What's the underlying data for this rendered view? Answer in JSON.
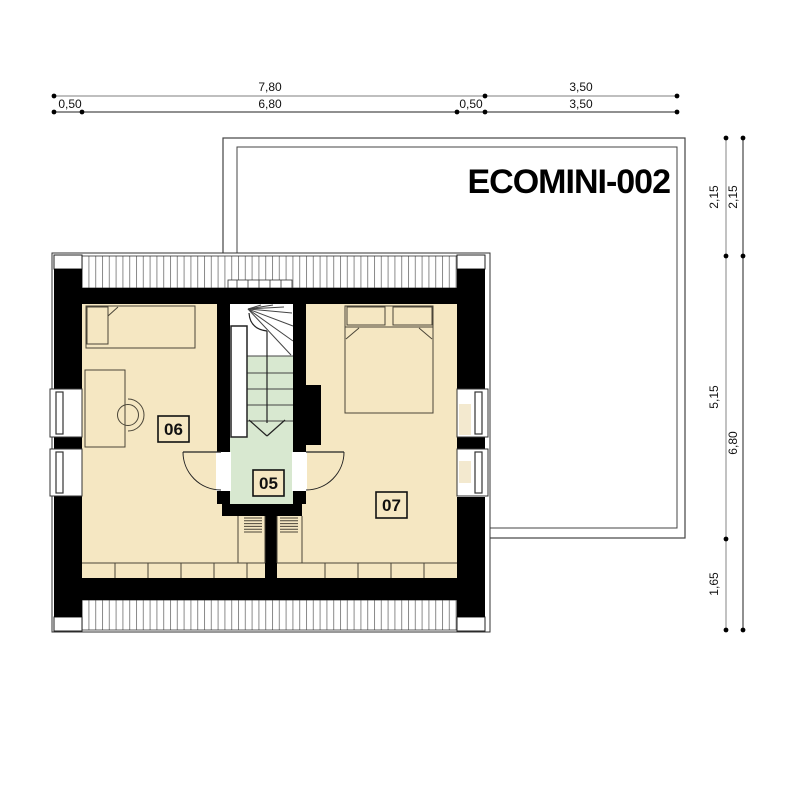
{
  "title": "ECOMINI-002",
  "room_labels": {
    "landing": "05",
    "left_bedroom": "06",
    "right_bedroom": "07"
  },
  "dimensions": {
    "top_row_total": [
      "7,80",
      "3,50"
    ],
    "top_row_segments": [
      "0,50",
      "6,80",
      "0,50",
      "3,50"
    ],
    "right_col_segments": [
      "2,15",
      "5,15",
      "1,65"
    ],
    "right_col_total": [
      "2,15",
      "6,80"
    ]
  },
  "colors": {
    "floor": "#f5e7c2",
    "stair_green": "#d8e8d0",
    "window_sill": "#f3e9cf",
    "wall": "#000000"
  }
}
